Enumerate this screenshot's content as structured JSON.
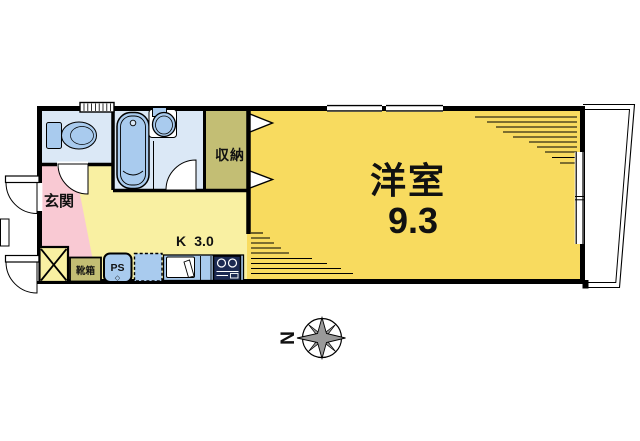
{
  "labels": {
    "western_room": "洋室",
    "western_room_size": "9.3",
    "kitchen": "K",
    "kitchen_size": "3.0",
    "closet": "収納",
    "entrance": "玄関",
    "shoe_cabinet": "靴箱",
    "pipe_shaft": "PS",
    "pipe_shaft_mark": "◇",
    "compass_north": "N"
  },
  "colors": {
    "wall_black": "#000000",
    "room_yellow": "#F8DB5F",
    "hall_yellow": "#F9F0A2",
    "entrance_pink": "#F9C9D3",
    "wet_blue": "#DBE8F6",
    "fixture_blue": "#A9CBEE",
    "closet_olive": "#C3BE74",
    "stove_navy": "#1C2A52",
    "compass_gray": "#9A9A9A"
  }
}
